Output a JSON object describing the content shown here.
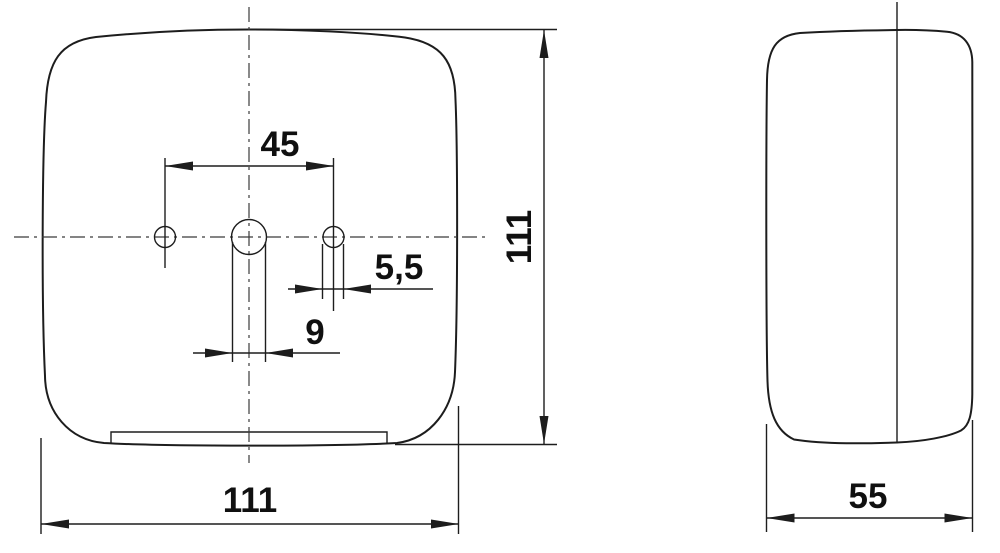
{
  "drawing": {
    "background_color": "#ffffff",
    "line_color": "#1d1d1d",
    "centerline_color": "#3b3b3b",
    "text_color": "#101010",
    "front_view": {
      "label": "front view",
      "dimensions": {
        "hole_spacing": "45",
        "small_slot_width": "5,5",
        "center_slot_width": "9",
        "overall_height": "111",
        "overall_width": "111"
      }
    },
    "side_view": {
      "label": "side view",
      "dimensions": {
        "overall_depth": "55"
      }
    }
  }
}
